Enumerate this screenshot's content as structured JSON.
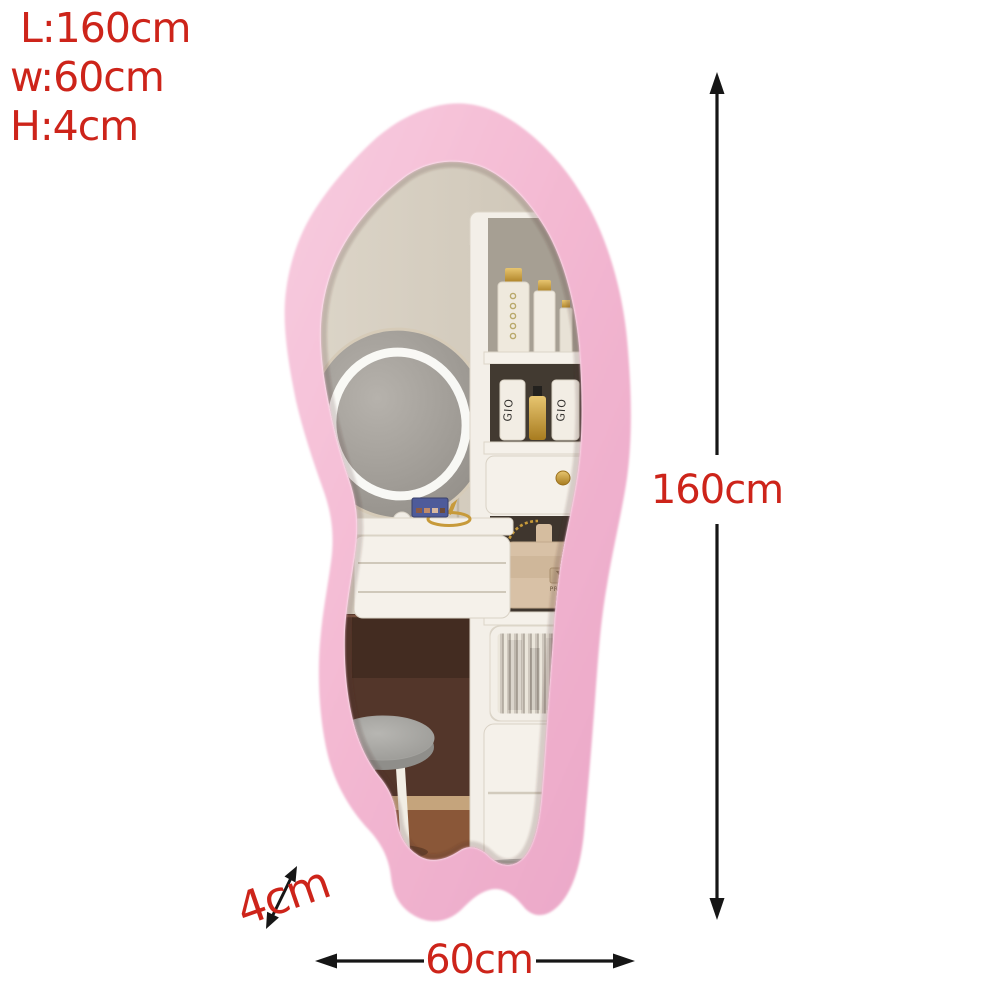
{
  "page": {
    "background": "#ffffff"
  },
  "spec_block": {
    "lines": [
      "L:160cm",
      "w:60cm",
      "H:4cm"
    ],
    "text_color": "#cd241a"
  },
  "dimension_annotations": {
    "height": {
      "label": "160cm"
    },
    "width": {
      "label": "60cm"
    },
    "depth": {
      "label": "4cm"
    },
    "line_color": "#161616",
    "label_color": "#cd241a"
  },
  "colors": {
    "frame_pink": "#f3b7d1",
    "frame_pink_light": "#f8cde0",
    "frame_pink_shade": "#eaa6c7",
    "accent_red": "#cd241a",
    "wall_beige": "#d5cdc0",
    "wall_dark_brown": "#53362a",
    "baseboard_tan": "#c5a47c",
    "floor_brown": "#8a5738",
    "furniture_white": "#f4f0e9",
    "niche_dark": "#423a31",
    "gold": "#c79a3a",
    "handbag_beige": "#d8c1a6",
    "stool_gray": "#a6a5a1"
  },
  "reflection_labels": {
    "cosmetic_tube": "GIO",
    "handbag_brand": "PRADA"
  }
}
